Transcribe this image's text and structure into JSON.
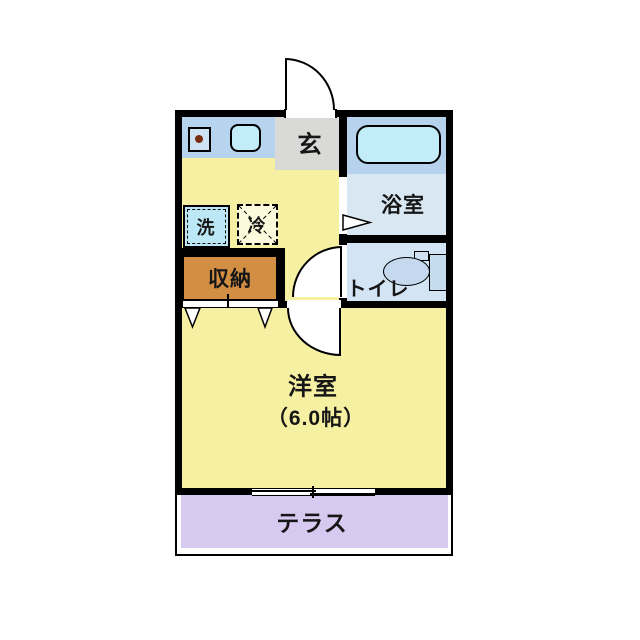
{
  "rooms": {
    "genkan": "玄",
    "bathroom": "浴室",
    "toilet": "トイレ",
    "closet": "収納",
    "washer": "洗",
    "fridge": "冷",
    "main_room": "洋室",
    "main_room_size": "（6.0帖）",
    "terrace": "テラス"
  },
  "colors": {
    "wall_black": "#000000",
    "floor_yellow": "#f6f1a2",
    "counter_blue": "#b7d4ee",
    "genkan_gray": "#d9d9d7",
    "bath_upper_blue": "#b7d2ec",
    "bath_lower_blue": "#d9e7f2",
    "toilet_blue": "#d3e5f5",
    "fixture_cyan": "#c2ecf7",
    "closet_brown": "#d28f44",
    "terrace_lavender": "#d7c9ef",
    "stove_dot_brown": "#7a2e10"
  }
}
